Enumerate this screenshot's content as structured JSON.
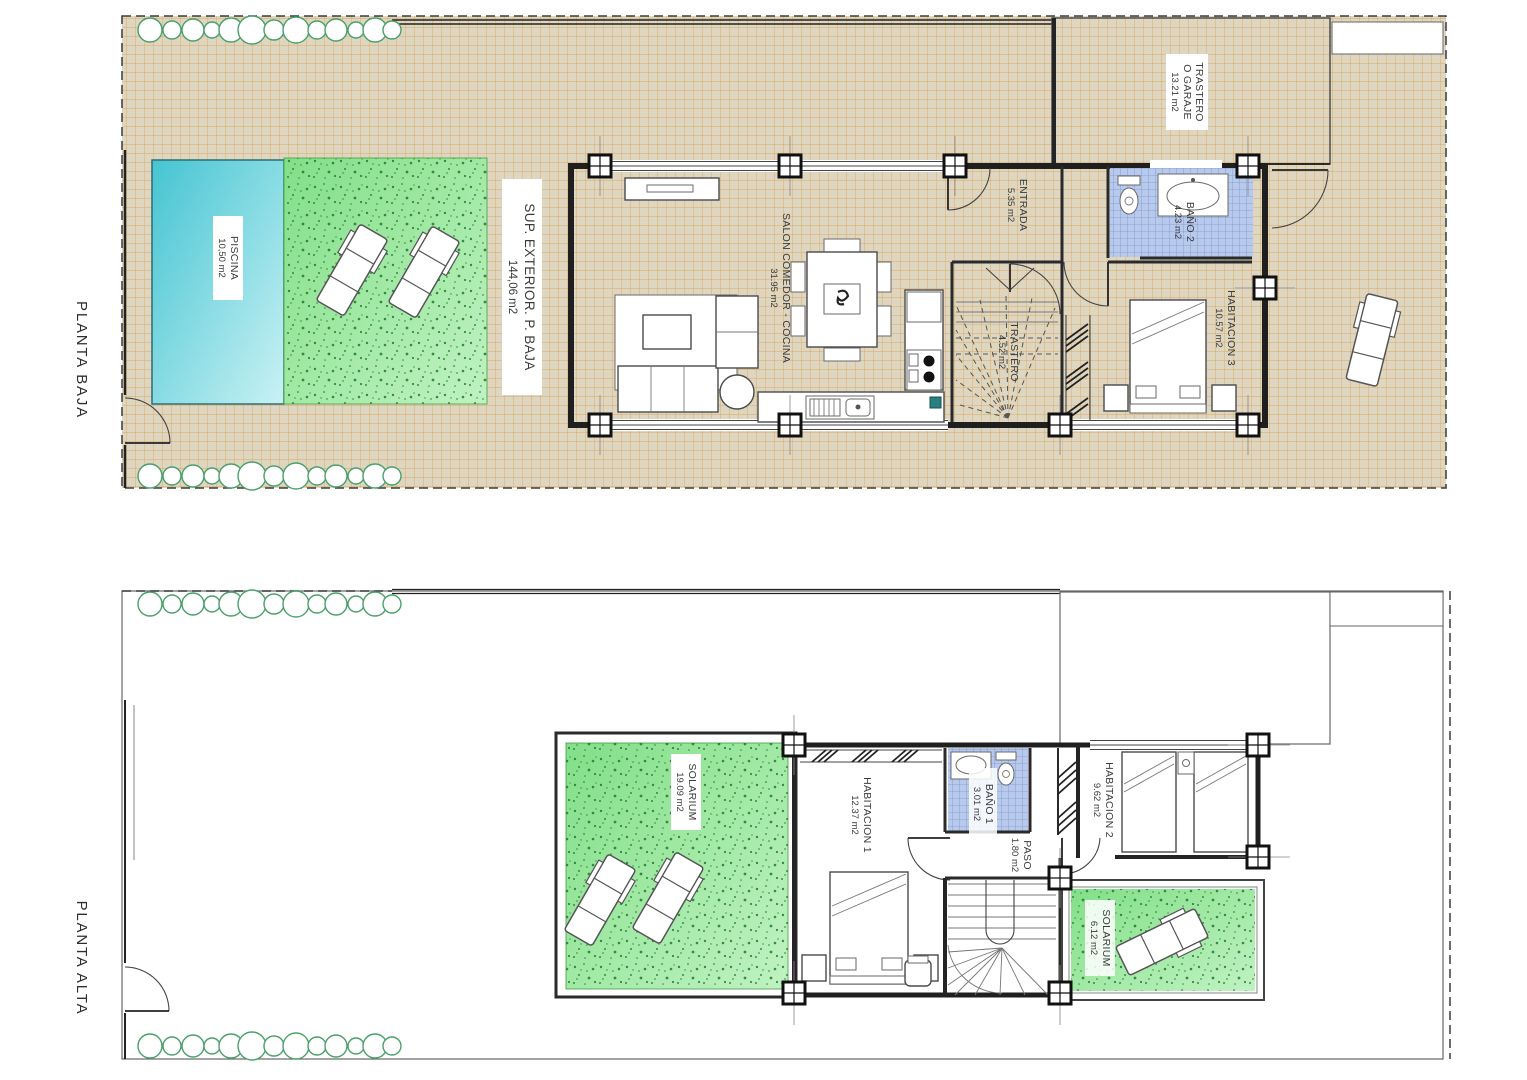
{
  "document": {
    "type": "architectural floor plan",
    "units": "m2"
  },
  "colors": {
    "terrace": "#ded6c1",
    "terrace_grid": "#d9a14b",
    "pool": "#4cc9d4",
    "grass": "#86e08d",
    "tile": "#b7c9ec",
    "wall": "#1f1f1f",
    "tree": "#4aa06a",
    "label": "#3b3b3b"
  },
  "floors": [
    {
      "id": "planta-baja",
      "label": "PLANTA BAJA",
      "rooms": {
        "piscina": {
          "name": "PISCINA",
          "area": "10,50 m2"
        },
        "sup_exterior": {
          "name": "SUP. EXTERIOR. P. BAJA",
          "area": "144,06 m2"
        },
        "salon": {
          "name": "SALON COMEDOR - COCINA",
          "area": "31.95 m2"
        },
        "entrada": {
          "name": "ENTRADA",
          "area": "5.35 m2"
        },
        "bano2": {
          "name": "BAÑO 2",
          "area": "4.23 m2"
        },
        "habitacion3": {
          "name": "HABITACION 3",
          "area": "10.57 m2"
        },
        "trastero": {
          "name": "TRASTERO",
          "area": "4.52 m2"
        },
        "garaje": {
          "line1": "TRASTERO",
          "line2": "O GARAJE",
          "area": "13.21 m2"
        }
      }
    },
    {
      "id": "planta-alta",
      "label": "PLANTA ALTA",
      "rooms": {
        "solarium_grande": {
          "name": "SOLARIUM",
          "area": "19.09 m2"
        },
        "habitacion1": {
          "name": "HABITACION 1",
          "area": "12.37 m2"
        },
        "bano1": {
          "name": "BAÑO 1",
          "area": "3.01 m2"
        },
        "paso": {
          "name": "PASO",
          "area": "1.80 m2"
        },
        "habitacion2": {
          "name": "HABITACION 2",
          "area": "9.62 m2"
        },
        "solarium_pequeno": {
          "name": "SOLARIUM",
          "area": "6.12 m2"
        }
      }
    }
  ]
}
